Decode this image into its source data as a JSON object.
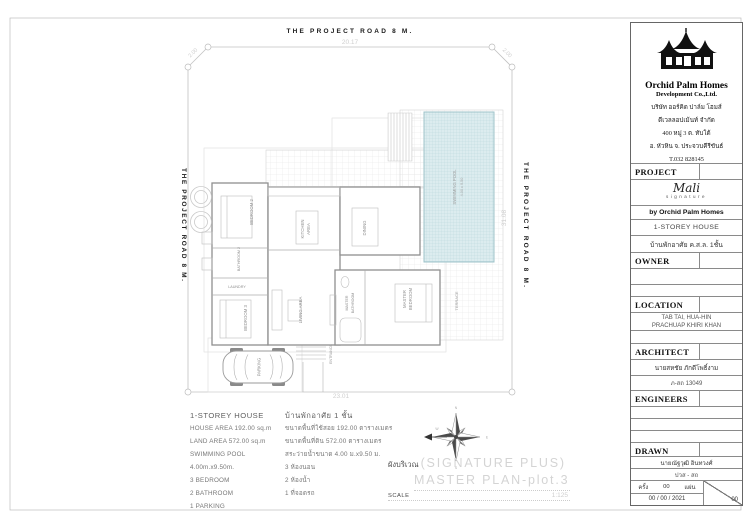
{
  "colors": {
    "pool_fill": "#dcecef",
    "pool_grid": "#b7d6db",
    "plan_line": "#9a9a9a",
    "dim_text": "#cfcfcf",
    "watermark": "#d4d4d4",
    "road_text": "#1a1a1a"
  },
  "company": {
    "name": "Orchid Palm Homes",
    "subtitle": "Development Co.,Ltd.",
    "address": [
      "บริษัท ออร์คิด ปาล์ม โฮมส์",
      "ดีเวลลอปเม้นท์ จำกัด",
      "400 หมู่ 3 ต. ทับใต้",
      "อ. หัวหิน จ. ประจวบคีรีขันธ์",
      "T.032 828145"
    ]
  },
  "title_block": {
    "project": {
      "label": "PROJECT",
      "script": "Mali",
      "script_sub": "signature",
      "by": "by  Orchid Palm Homes",
      "house": "1-STOREY HOUSE",
      "house_th": "บ้านพักอาศัย ค.ส.ล. 1ชั้น"
    },
    "owner_label": "OWNER",
    "location": {
      "label": "LOCATION",
      "line1": "TAB TAI, HUA-HIN",
      "line2": "PRACHUAP KHIRI KHAN"
    },
    "architect": {
      "label": "ARCHITECT",
      "name": "นายสหชัย ภักดีโพธิ์งาม",
      "reg": "ภ-สถ 13049"
    },
    "engineers_label": "ENGINEERS",
    "drawn": {
      "label": "DRAWN",
      "name": "นายณัฐวุฒิ อินทวงศ์",
      "qual": "ปวส - สถ",
      "copies": "ครั้ง",
      "copies_n": "00",
      "sheet_word": "แผ่น",
      "date": "00 / 00 / 2021",
      "sheet_no": "00"
    }
  },
  "roads": {
    "top": "THE PROJECT ROAD 8 M.",
    "left": "THE PROJECT ROAD 8 M.",
    "right": "THE PROJECT ROAD 8 M."
  },
  "dims": {
    "top": "20.17",
    "chamfer": "2.00",
    "right": "31.08",
    "bottom": "23.01"
  },
  "rooms": {
    "bedroom2": "BEDROOM 2",
    "bathroom2": "BATHROOM 2",
    "laundry": "LAUNDRY",
    "bedroom3": "BEDROOM 3",
    "living": "LIVING AREA",
    "kitchen_l1": "KITCHEN",
    "kitchen_l2": "AREA",
    "dining": "DINING",
    "master_l1": "MASTER",
    "master_l2": "BEDROOM",
    "mbath_l1": "MASTER",
    "mbath_l2": "BATHROOM",
    "terrace": "TERRACE",
    "entrance": "ENTRANCE",
    "parking": "PARKING",
    "pool_l1": "SWIMMING POOL",
    "pool_l2": "4.00 x 9.50"
  },
  "caption": {
    "prefix": "ผังบริเวณ",
    "wm1": "(SIGNATURE PLUS)",
    "wm2": "MASTER PLAN-plot.3",
    "scale_label": "SCALE",
    "scale_value": "1:125"
  },
  "specs": {
    "en": [
      "1-STOREY HOUSE",
      "HOUSE AREA 192.00 sq.m",
      "LAND AREA 572.00 sq.m",
      "SWIMMING POOL 4.00m.x9.50m.",
      "3 BEDROOM",
      "2 BATHROOM",
      "1 PARKING"
    ],
    "th": [
      "บ้านพักอาศัย 1 ชั้น",
      "ขนาดพื้นที่ใช้สอย 192.00 ตารางเมตร",
      "ขนาดพื้นที่ดิน 572.00 ตารางเมตร",
      "สระว่ายน้ำขนาด 4.00 ม.x9.50 ม.",
      "3 ห้องนอน",
      "2 ห้องน้ำ",
      "1 ที่จอดรถ"
    ]
  }
}
